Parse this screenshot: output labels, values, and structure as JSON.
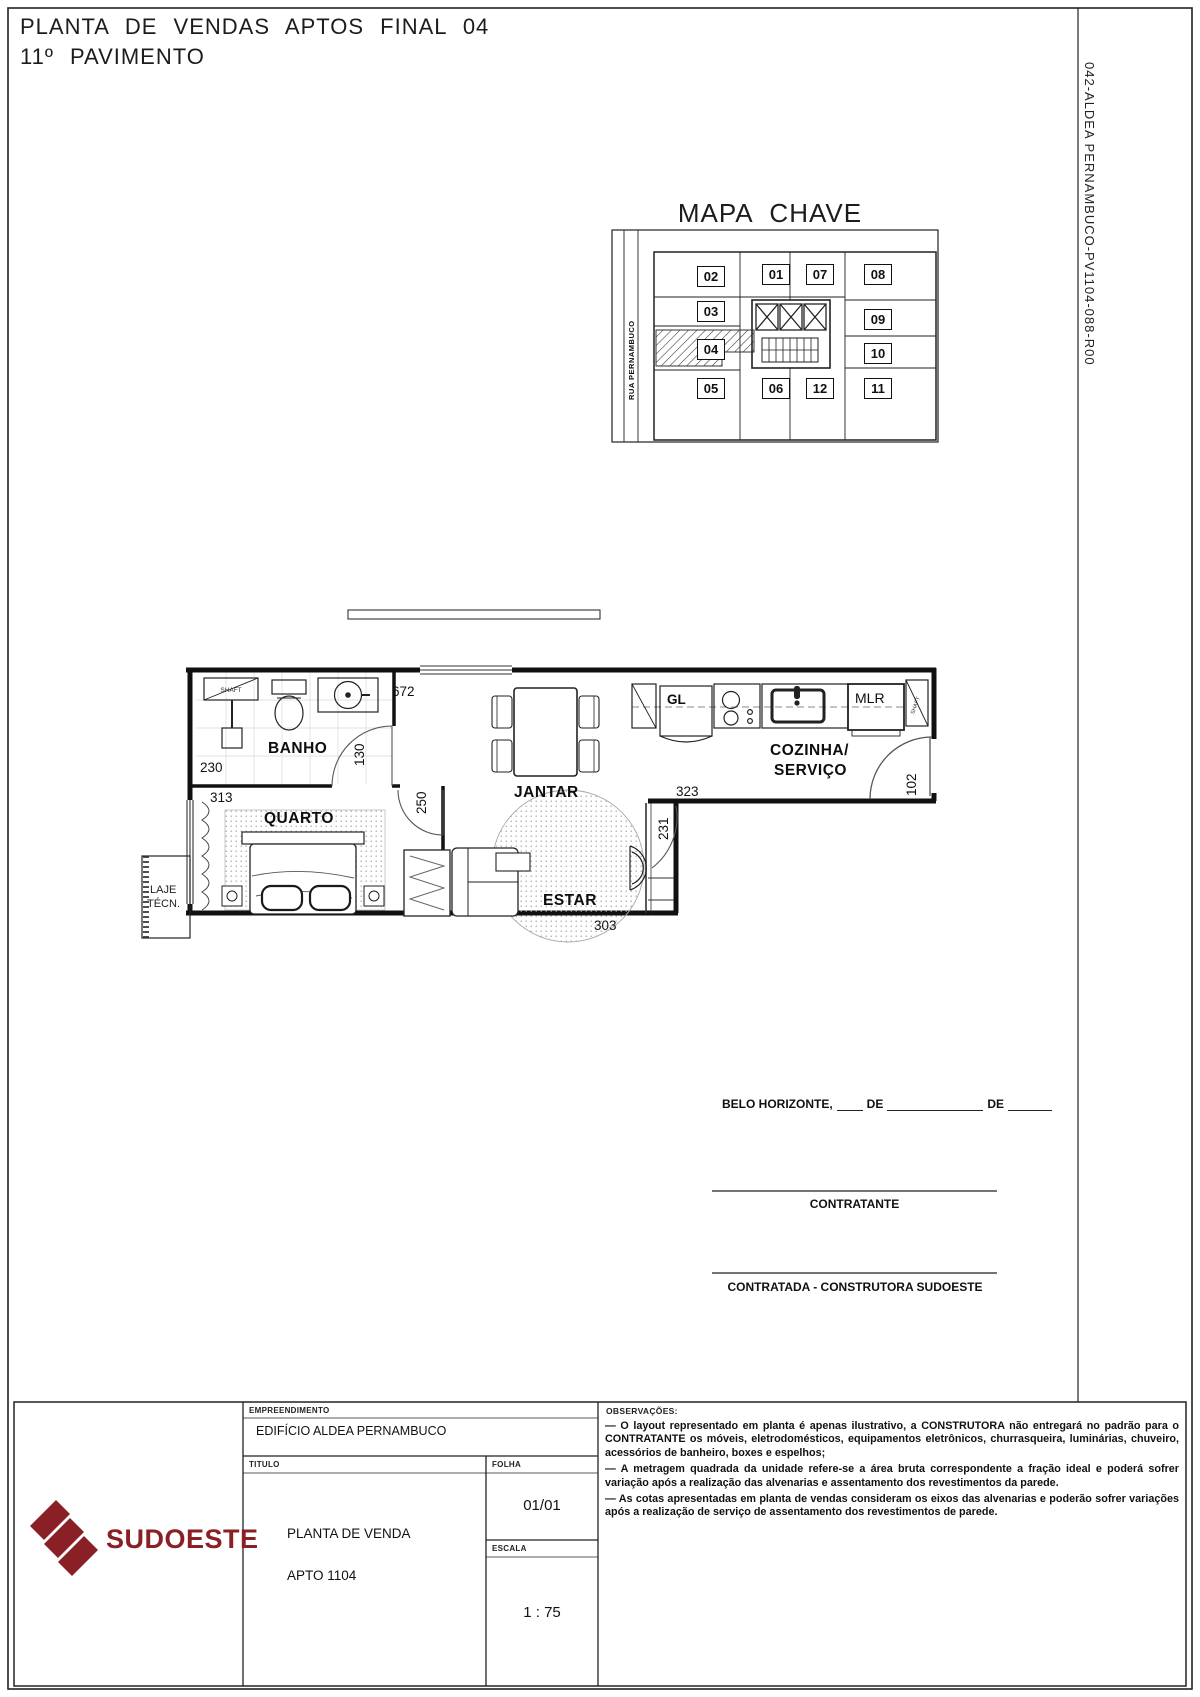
{
  "page": {
    "title_line1": "PLANTA DE VENDAS APTOS FINAL 04",
    "title_line2": "11º PAVIMENTO",
    "doc_number": "042-ALDEA PERNAMBUCO-PV1104-088-R00"
  },
  "key_map": {
    "title": "MAPA CHAVE",
    "street": "RUA PERNAMBUCO",
    "units": [
      "02",
      "01",
      "07",
      "08",
      "03",
      "09",
      "04",
      "10",
      "05",
      "06",
      "12",
      "11"
    ],
    "highlighted_unit": "04"
  },
  "plan": {
    "rooms": {
      "banho": "BANHO",
      "quarto": "QUARTO",
      "jantar": "JANTAR",
      "estar": "ESTAR",
      "cozinha_line1": "COZINHA/",
      "cozinha_line2": "SERVIÇO",
      "laje_line1": "LAJE",
      "laje_line2": "TÉCN."
    },
    "fixtures": {
      "gl": "GL",
      "mlr": "MLR",
      "shaft_banho": "SHAFT",
      "shaft_servico": "SHAFT"
    },
    "dims": {
      "d672": "672",
      "d230": "230",
      "d130": "130",
      "d313": "313",
      "d250": "250",
      "d323": "323",
      "d231": "231",
      "d102": "102",
      "d303": "303"
    }
  },
  "signature": {
    "city": "BELO HORIZONTE,",
    "de1": "DE",
    "de2": "DE",
    "contratante": "CONTRATANTE",
    "contratada": "CONTRATADA - CONSTRUTORA SUDOESTE"
  },
  "title_block": {
    "empreendimento_label": "EMPREENDIMENTO",
    "empreendimento_value": "EDIFÍCIO ALDEA PERNAMBUCO",
    "titulo_label": "TITULO",
    "titulo_line1": "PLANTA DE VENDA",
    "titulo_line2": "APTO 1104",
    "folha_label": "FOLHA",
    "folha_value": "01/01",
    "escala_label": "ESCALA",
    "escala_value": "1 : 75",
    "observacoes_label": "OBSERVAÇÕES:",
    "observacoes": [
      "—    O layout representado em planta é apenas ilustrativo, a CONSTRUTORA não entregará no padrão para o CONTRATANTE os móveis, eletrodomésticos, equipamentos eletrônicos, churrasqueira, luminárias, chuveiro, acessórios de banheiro, boxes e espelhos;",
      "—    A metragem quadrada da unidade refere-se a área bruta correspondente a fração ideal e poderá sofrer variação após a realização das alvenarias e assentamento dos revestimentos da parede.",
      "—    As cotas apresentadas em planta de vendas consideram os eixos das alvenarias e poderão sofrer variações após a realização de serviço de assentamento dos revestimentos de parede."
    ],
    "logo_text": "SUDOESTE"
  },
  "colors": {
    "line": "#111111",
    "logo": "#8a2025"
  }
}
